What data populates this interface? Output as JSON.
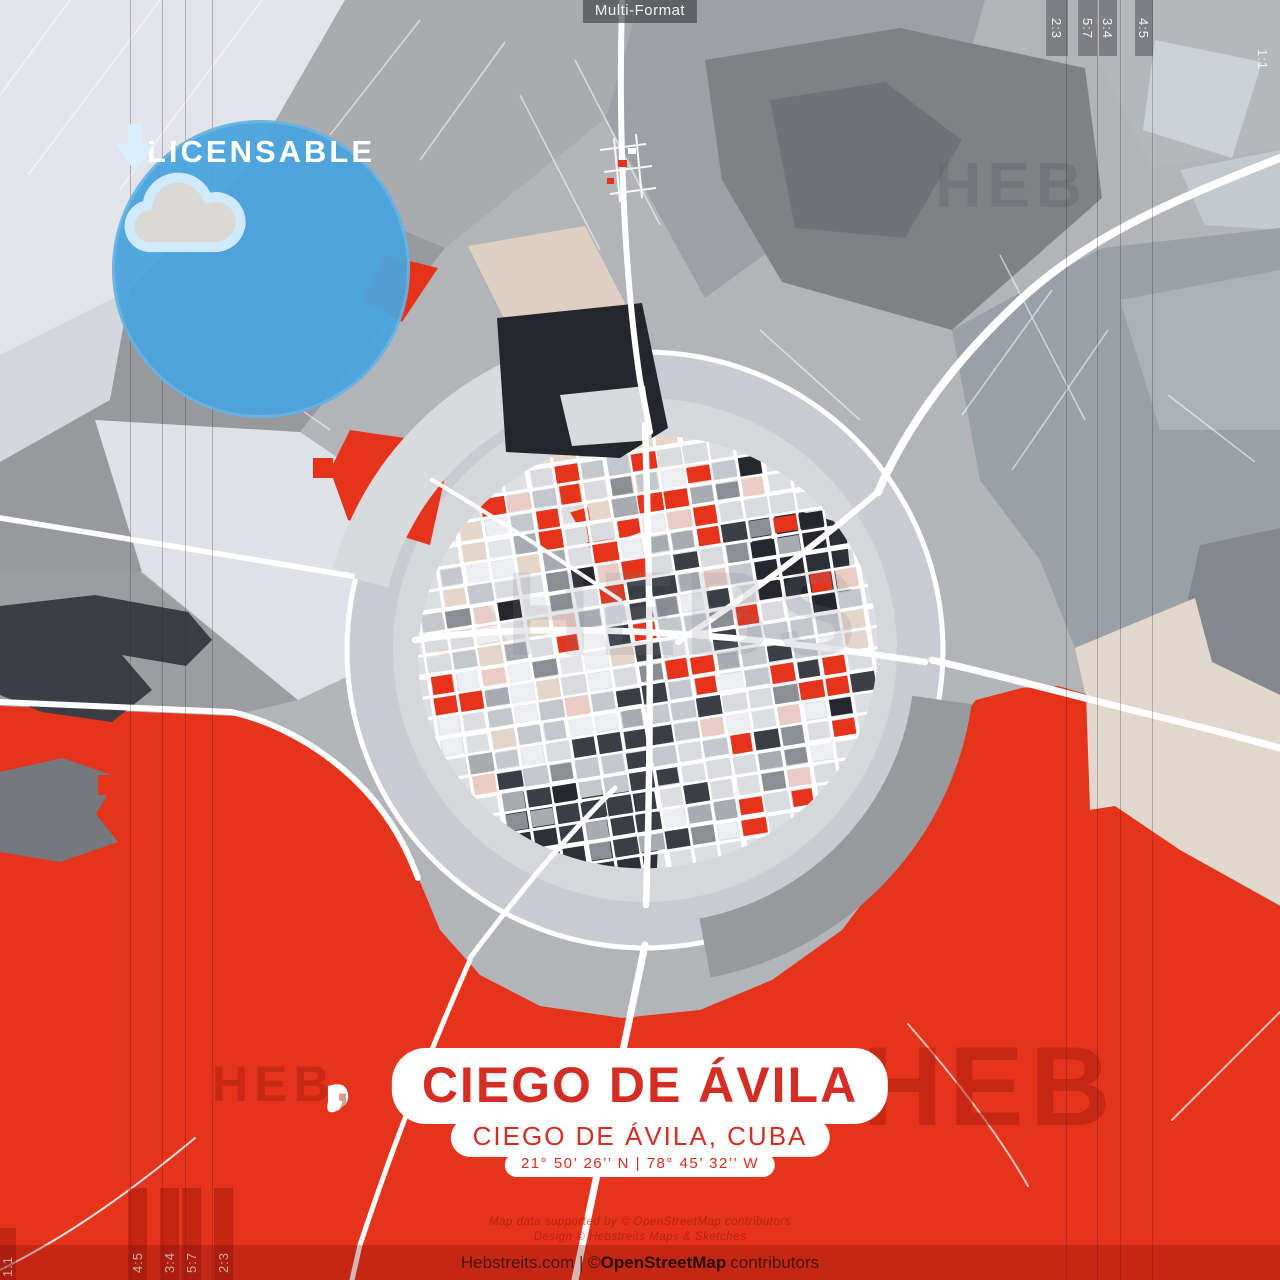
{
  "meta": {
    "format_label": "Multi-Format"
  },
  "ratios": {
    "top": [
      "2:3",
      "5:7",
      "3:4",
      "4:5"
    ],
    "top_edge": "1:1",
    "bottom": [
      "4:5",
      "3:4",
      "5:7",
      "2:3"
    ],
    "bottom_edge": "1:1"
  },
  "badge": {
    "label": "LICENSABLE",
    "icon": "cloud-download-icon",
    "color": "#4aa4dd"
  },
  "title_block": {
    "title": "CIEGO DE ÁVILA",
    "subtitle": "CIEGO DE ÁVILA, CUBA",
    "coordinates": "21°  50’  26’’ N  |  78°  45’  32’’ W",
    "text_color": "#d42d24"
  },
  "credits": {
    "line1": "Map data supported by © OpenStreetMap contributors",
    "line2": "Design © Hebstreits Maps & Sketches"
  },
  "attribution": {
    "prefix": "Hebstreits.com | © ",
    "brand": "OpenStreetMap",
    "suffix": " contributors"
  },
  "watermark": {
    "text": "HEB",
    "text_comma": "HEB,",
    "text_center": "HEBS"
  },
  "map": {
    "red": "#e6331c",
    "road_color": "#ffffff",
    "palette": [
      "#eceef1",
      "#d9dbdf",
      "#c4c7cc",
      "#a8abb0",
      "#8b8e93",
      "#3b3e45",
      "#25272d",
      "#e6331c",
      "#e4d7ca",
      "#eaccc5"
    ]
  }
}
